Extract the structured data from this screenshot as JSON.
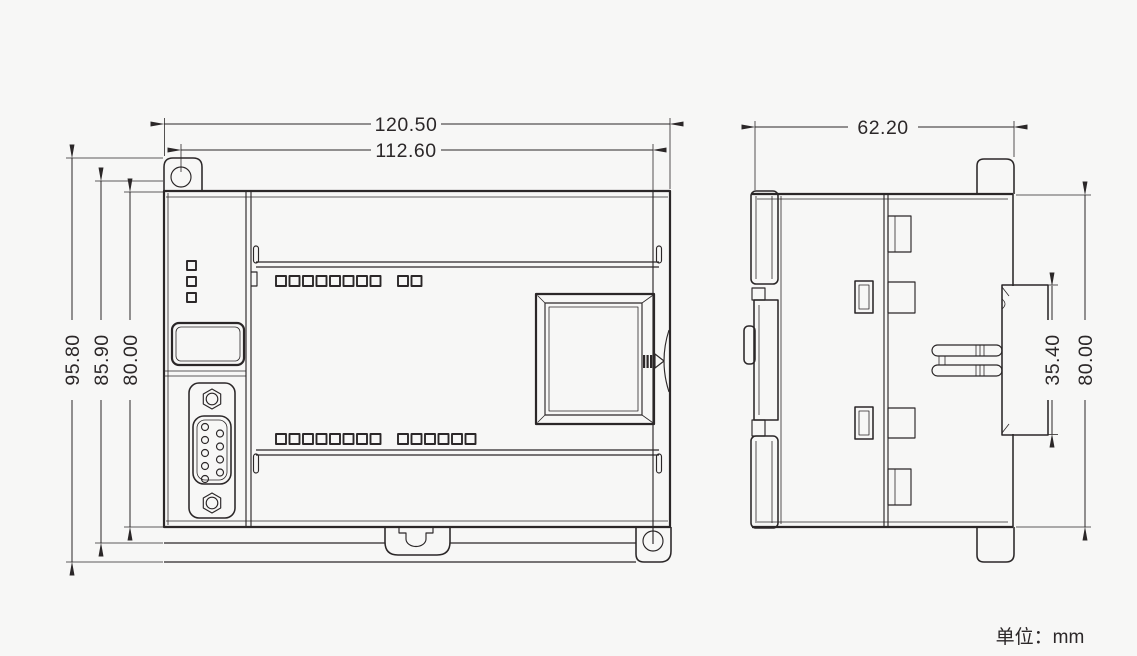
{
  "front_view": {
    "dim_overall_width": "120.50",
    "dim_mounting_hole_span": "112.60",
    "dim_overall_height": "95.80",
    "dim_mid_height": "85.90",
    "dim_body_height": "80.00"
  },
  "side_view": {
    "dim_depth": "62.20",
    "dim_din_section_height": "35.40",
    "dim_body_height": "80.00"
  },
  "footer": {
    "unit_label": "单位：mm"
  },
  "colors": {
    "line": "#2b2728",
    "background": "#f7f7f6"
  }
}
